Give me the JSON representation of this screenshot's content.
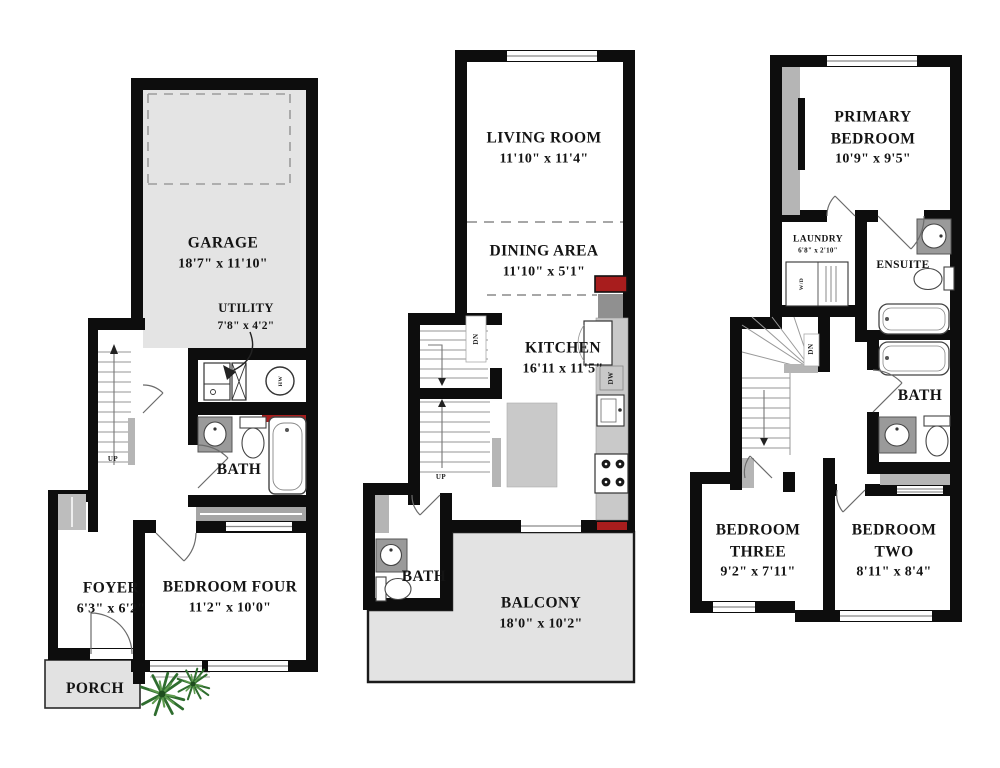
{
  "floor1": {
    "garage": {
      "name": "GARAGE",
      "dims": "18'7\" x 11'10\""
    },
    "utility": {
      "name": "UTILITY",
      "dims": "7'8\" x 4'2\""
    },
    "bath": {
      "name": "BATH"
    },
    "foyer": {
      "name": "FOYER",
      "dims": "6'3\" x 6'2\""
    },
    "bedroom_four": {
      "name": "BEDROOM FOUR",
      "dims": "11'2\" x 10'0\""
    },
    "porch": {
      "name": "PORCH"
    },
    "stairs_up": "UP",
    "water_heater": "HW"
  },
  "floor2": {
    "living_room": {
      "name": "LIVING ROOM",
      "dims": "11'10\" x 11'4\""
    },
    "dining_area": {
      "name": "DINING AREA",
      "dims": "11'10\" x 5'1\""
    },
    "kitchen": {
      "name": "KITCHEN",
      "dims": "16'11 x 11'5\""
    },
    "bath": {
      "name": "BATH"
    },
    "balcony": {
      "name": "BALCONY",
      "dims": "18'0\" x 10'2\""
    },
    "stairs_up": "UP",
    "stairs_dn": "DN",
    "dishwasher": "DW"
  },
  "floor3": {
    "primary_bedroom": {
      "line1": "PRIMARY",
      "line2": "BEDROOM",
      "dims": "10'9\" x 9'5\""
    },
    "laundry": {
      "name": "LAUNDRY",
      "dims": "6'8\" x 2'10\""
    },
    "ensuite": {
      "name": "ENSUITE"
    },
    "bath": {
      "name": "BATH"
    },
    "bedroom_three": {
      "line1": "BEDROOM",
      "line2": "THREE",
      "dims": "9'2\" x 7'11\""
    },
    "bedroom_two": {
      "line1": "BEDROOM",
      "line2": "TWO",
      "dims": "8'11\" x 8'4\""
    },
    "stairs_dn": "DN",
    "washer_dryer": "W/D"
  },
  "colors": {
    "wall": "#0d0d0d",
    "area_fill": "#e4e4e4",
    "counter_fill": "#bdbdbd",
    "accent_red": "#a81d1d",
    "plant_green": "#2f6d2f"
  }
}
